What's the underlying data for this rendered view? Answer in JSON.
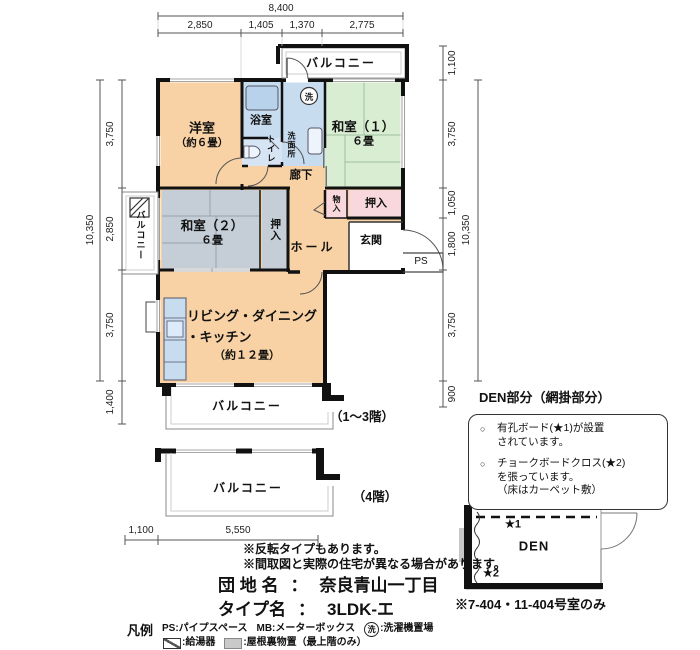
{
  "plan": {
    "rooms": {
      "western_name": "洋室",
      "western_size": "（約６畳）",
      "bath": "浴室",
      "toilet": "トイレ",
      "washroom": "洗面所",
      "washer_symbol": "洗",
      "washitsu1_name": "和室（１）",
      "washitsu1_size": "６畳",
      "corridor": "廊下",
      "washitsu2_name": "和室（２）",
      "washitsu2_size": "６畳",
      "oshiire_side": "押入",
      "monoire": "物入",
      "oshiire_top": "押入",
      "genkan": "玄関",
      "hall": "ホール",
      "ps": "PS",
      "ldk_line1": "リビング・ダイニング",
      "ldk_line2": "・キッチン",
      "ldk_size": "（約１２畳）"
    },
    "balconies": {
      "top": "バルコニー",
      "left": "バルコニー",
      "bottom": "バルコニー",
      "fourth": "バルコニー"
    },
    "floor_notes": {
      "floors_1_3": "（1～3階）",
      "floor_4": "（4階）"
    }
  },
  "dimensions": {
    "top_total": "8,400",
    "top_segments": [
      "2,850",
      "1,405",
      "1,370",
      "2,775"
    ],
    "left_total": "10,350",
    "left_segments": [
      "3,750",
      "2,850",
      "3,750",
      "1,400"
    ],
    "right_total": "10,350",
    "right_segments": [
      "1,100",
      "3,750",
      "1,050",
      "1,800",
      "3,750",
      "900"
    ],
    "bottom_segments": [
      "1,100",
      "5,550"
    ]
  },
  "den": {
    "title": "DEN部分（網掛部分）",
    "bullet_mark": "○",
    "bullet1_line1": "有孔ボード(★1)が設置",
    "bullet1_line2": "されています。",
    "bullet2_line1": "チョークボードクロス(★2)",
    "bullet2_line2": "を張っています。",
    "bullet2_line3": "（床はカーペット敷）",
    "star1": "★1",
    "star2": "★2",
    "room_label": "DEN",
    "footnote": "※7-404・11-404号室のみ"
  },
  "footer": {
    "note1": "※反転タイプもあります。",
    "note2": "※間取図と実際の住宅が異なる場合があります。",
    "estate_label": "団 地 名",
    "separator": "：",
    "estate_value": "奈良青山一丁目",
    "type_label": "タイプ名",
    "type_value": "3LDK-エ",
    "legend_title": "凡例",
    "legend_ps": "PS:パイプスペース",
    "legend_mb": "MB:メーターボックス",
    "legend_washer_symbol": "洗",
    "legend_washer": ":洗濯機置場",
    "legend_heater": ":給湯器",
    "legend_attic": ":屋根裏物置（最上階のみ）"
  },
  "colors": {
    "room_orange": "#F8D2A5",
    "room_green": "#D9EDD3",
    "room_gray": "#C5CDD6",
    "room_blue": "#C8DCF0",
    "room_pink": "#F8D8DC",
    "wall": "#111111"
  }
}
